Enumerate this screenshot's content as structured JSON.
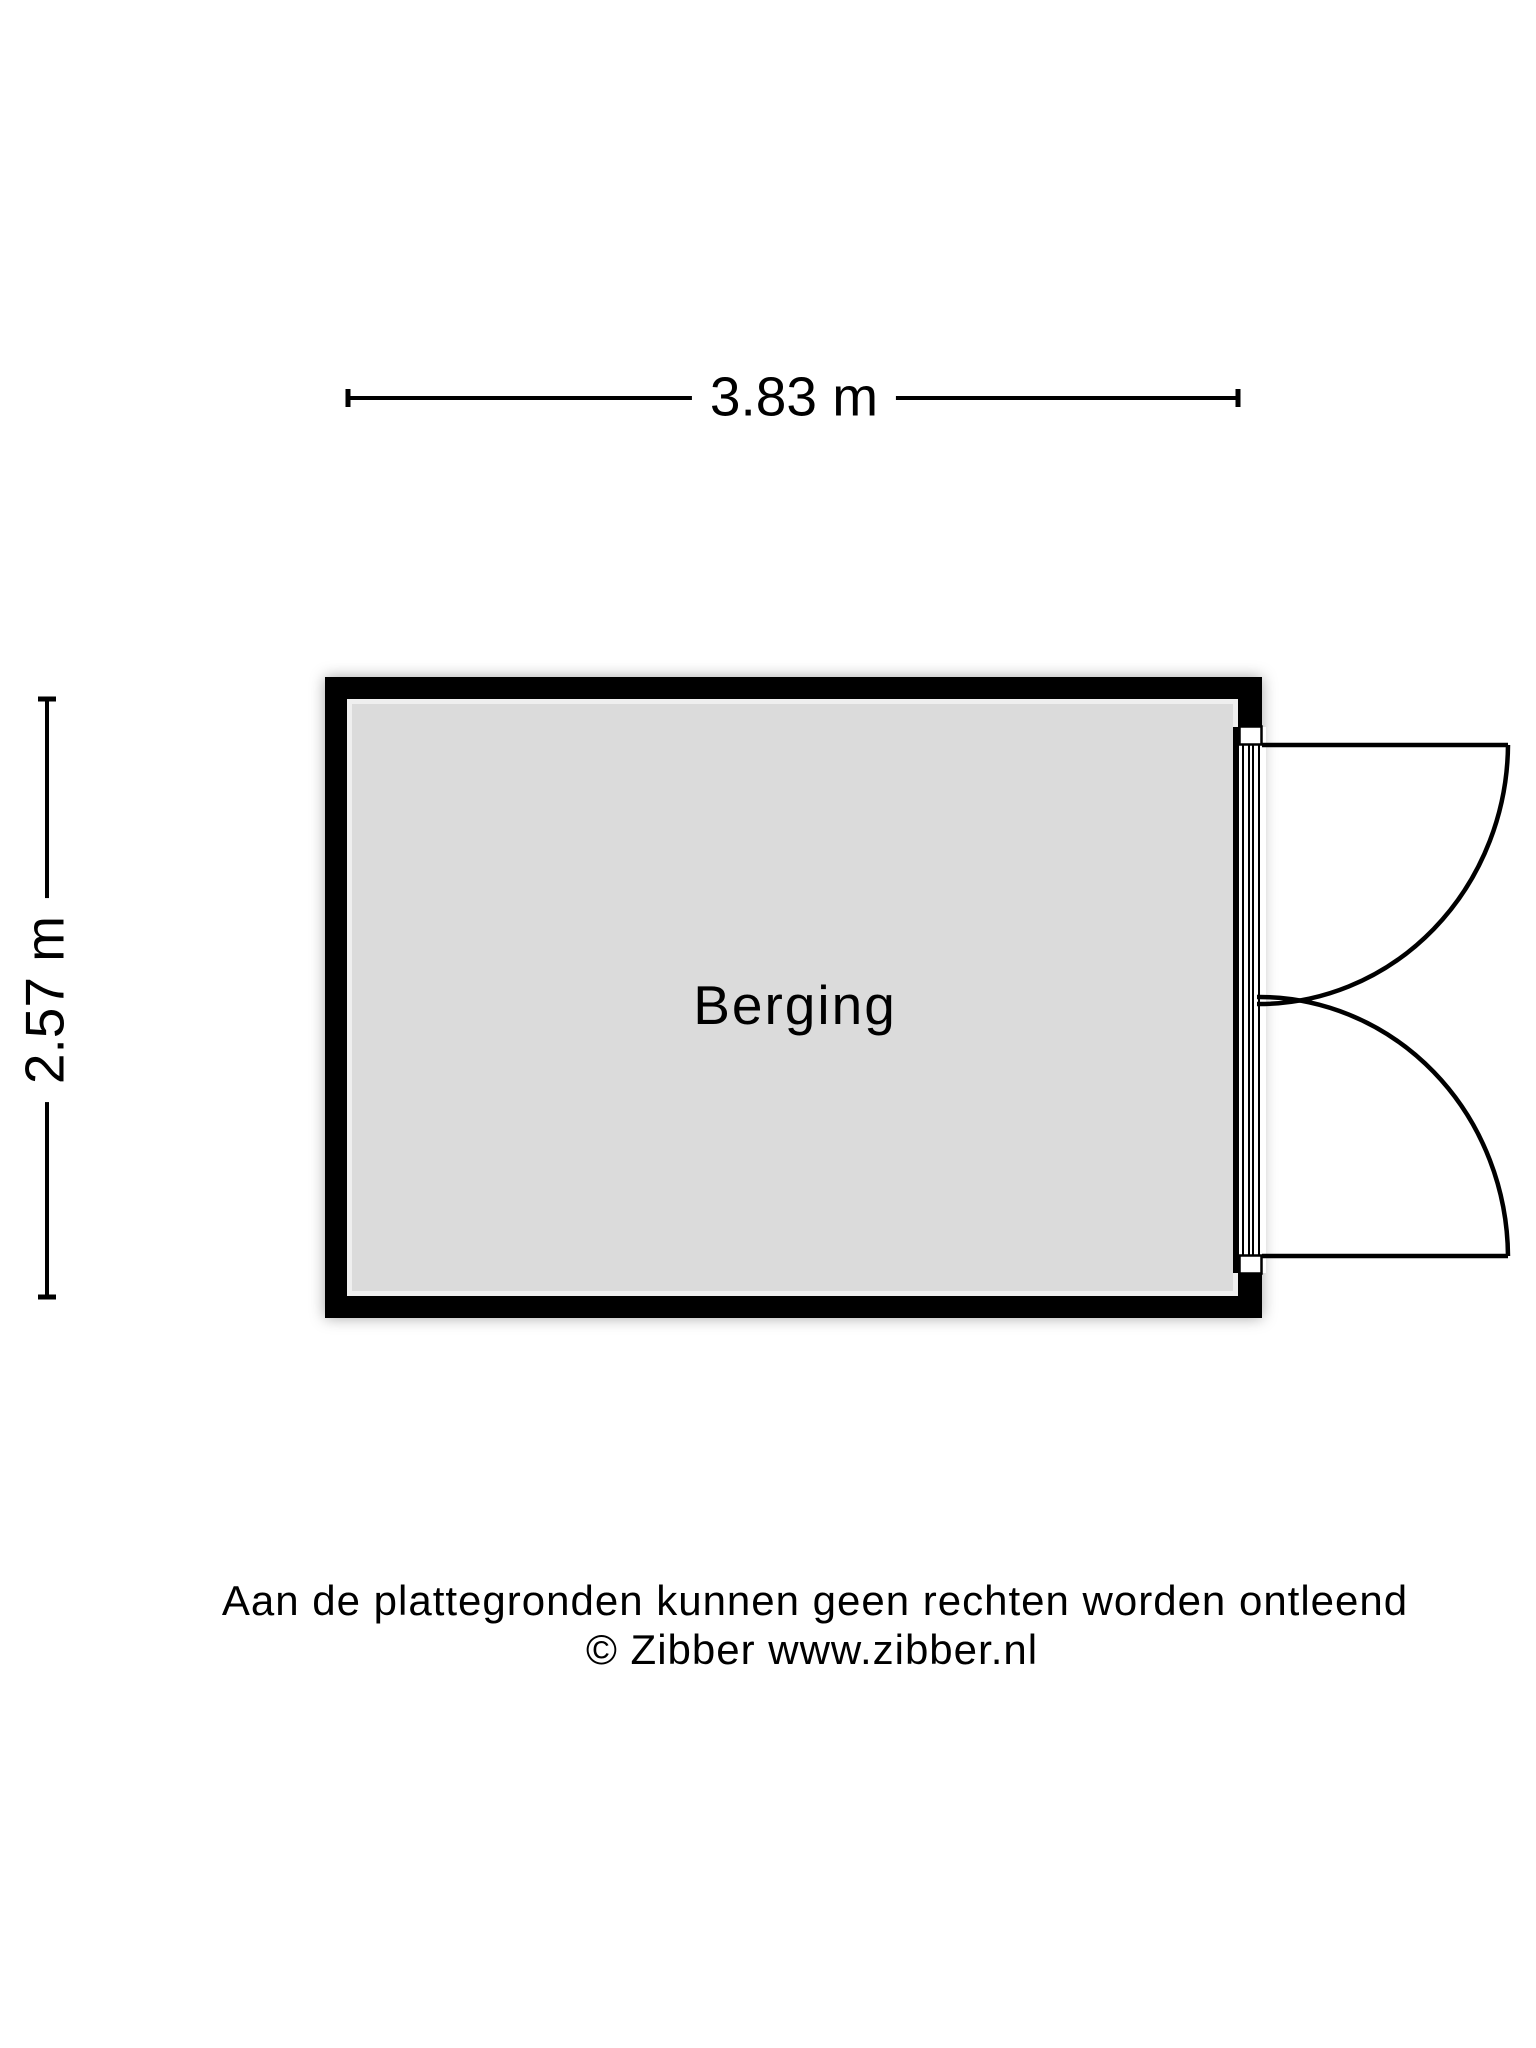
{
  "colors": {
    "background": "#ffffff",
    "wall": "#000000",
    "room_fill": "#dbdbdb",
    "room_inner_edge": "#efefef",
    "line": "#000000",
    "door_white": "#ffffff"
  },
  "dimensions": {
    "width_label": "3.83 m",
    "height_label": "2.57 m"
  },
  "room": {
    "name": "Berging"
  },
  "footer": {
    "line1": "Aan de plattegronden kunnen geen rechten worden ontleend",
    "line2": "© Zibber www.zibber.nl"
  }
}
